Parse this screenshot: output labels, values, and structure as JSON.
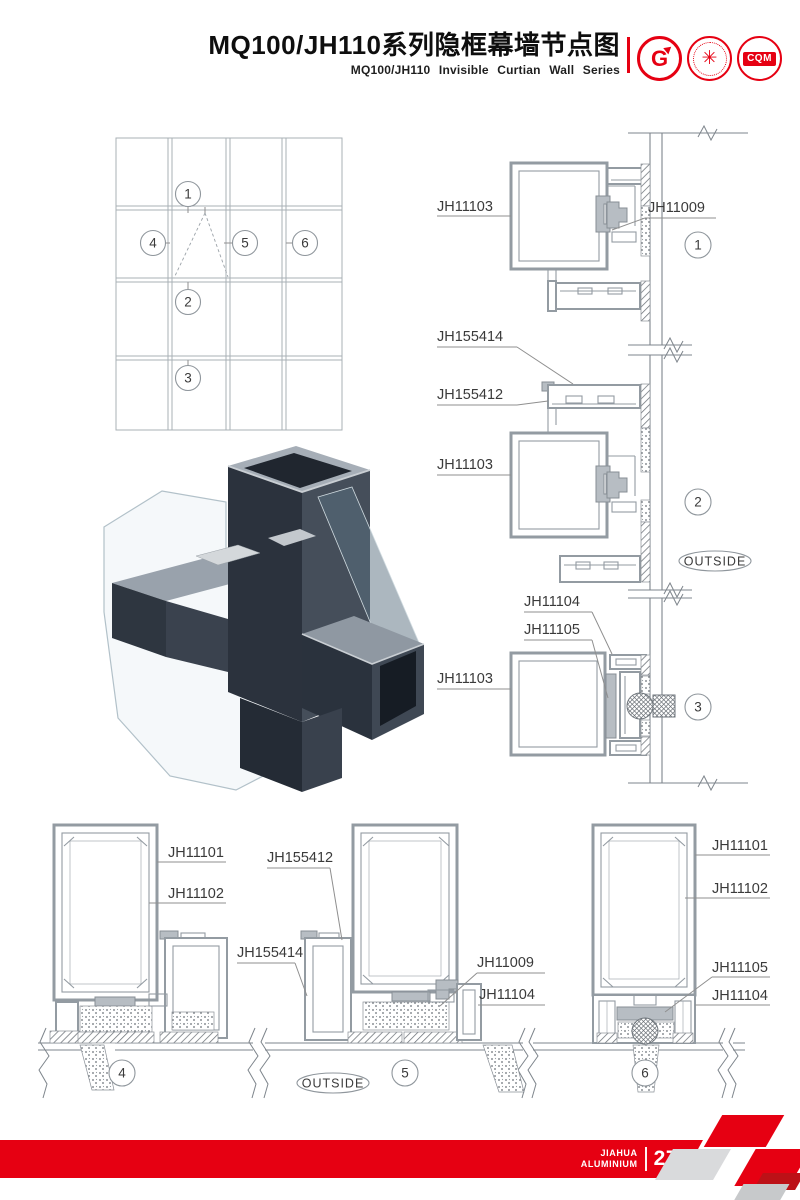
{
  "header": {
    "title_cn": "MQ100/JH110系列隐框幕墙节点图",
    "title_en": "MQ100/JH110 Invisible Curtian Wall Series",
    "logo_gb_text": "G",
    "logo_seal_glyph": "✳",
    "logo_cqm_text": "CQM"
  },
  "labels": {
    "jh11101": "JH11101",
    "jh11102": "JH11102",
    "jh11103": "JH11103",
    "jh11104": "JH11104",
    "jh11105": "JH11105",
    "jh11009": "JH11009",
    "jh155412": "JH155412",
    "jh155414": "JH155414"
  },
  "callouts": [
    "1",
    "2",
    "3",
    "4",
    "5",
    "6"
  ],
  "outside_label": "OUTSIDE",
  "footer": {
    "brand_line1": "JIAHUA",
    "brand_line2": "ALUMINIUM",
    "page_number": "27"
  },
  "colors": {
    "accent_red": "#e60012",
    "profile_gray": "#939ba2",
    "leader_gray": "#8f8f8f",
    "render_dark": "#2b323d",
    "render_mid": "#454e5a",
    "render_light": "#a6aeb7"
  }
}
